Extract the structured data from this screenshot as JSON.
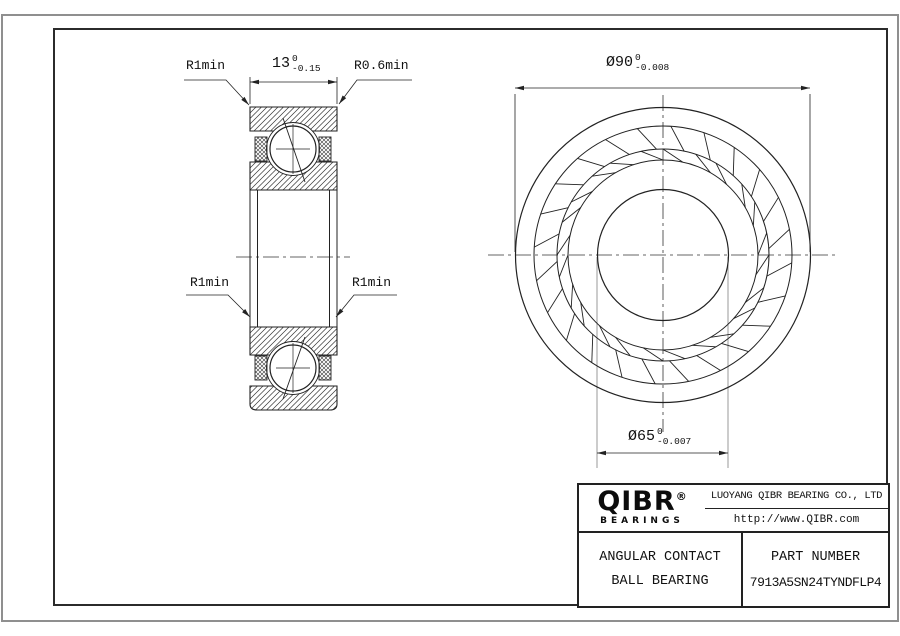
{
  "drawing": {
    "dim_width": {
      "value": "13",
      "tol_upper": "0",
      "tol_lower": "-0.15"
    },
    "dim_od": {
      "value": "Ø90",
      "tol_upper": "0",
      "tol_lower": "-0.008"
    },
    "dim_bore": {
      "value": "Ø65",
      "tol_upper": "0",
      "tol_lower": "-0.007"
    },
    "labels": {
      "r1_top": "R1min",
      "r06_top": "R0.6min",
      "r1_mid_left": "R1min",
      "r1_mid_right": "R1min"
    }
  },
  "title_block": {
    "logo": {
      "brand": "QIBR",
      "registered": "®",
      "sub": "BEARINGS"
    },
    "company": "LUOYANG QIBR BEARING CO., LTD",
    "website": "http://www.QIBR.com",
    "product_line1": "ANGULAR CONTACT",
    "product_line2": "BALL BEARING",
    "part_number_label": "PART NUMBER",
    "part_number": "7913A5SN24TYNDFLP4"
  }
}
